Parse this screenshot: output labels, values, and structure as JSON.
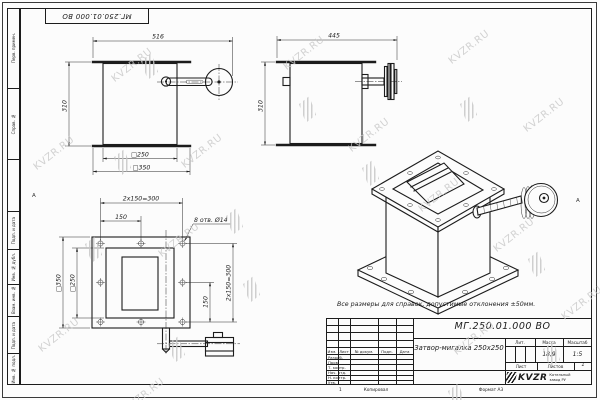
{
  "sheet": {
    "stamp_top_left": "МГ.250.01.000 ВО",
    "zone_letter": "А",
    "bottom_zone_number": "1",
    "copied_label": "Копировал",
    "format_label": "Формат А3",
    "note": "Все размеры для справок, допустимые отклонения ±50мм."
  },
  "margin": {
    "fields": [
      "Перв. примен.",
      "Справ. №",
      "Подп. и дата",
      "Инв. № дубл.",
      "Взам. инв. №",
      "Подп. и дата",
      "Инв. № подл."
    ]
  },
  "watermark": {
    "text": "KVZR.RU",
    "color": "#c7c7c7"
  },
  "views": {
    "front": {
      "width": "516",
      "height": "310",
      "inner_square": "□250",
      "outer_square": "□350"
    },
    "side": {
      "width": "445",
      "height": "310"
    },
    "plan": {
      "bolt_spacing_h": "2x150=300",
      "bolt_half_h": "150",
      "holes_note": "8 отв. Ø14",
      "inner_square": "□250",
      "outer_square": "□350",
      "bolt_spacing_v": "2x150=300",
      "bolt_half_v": "150"
    }
  },
  "title_block": {
    "doc_number": "МГ.250.01.000 ВО",
    "product_name": "Затвор-мигалка 250x250",
    "change_headers": [
      "Изм.",
      "Лист",
      "№ докум.",
      "Подп.",
      "Дата"
    ],
    "signature_rows": [
      "Разраб.",
      "Пров.",
      "Т. контр.",
      "Нач. отд.",
      "Н. контр.",
      "Утв."
    ],
    "lit_label": "Лит.",
    "mass_label": "Масса",
    "scale_label": "Масштаб",
    "mass_value": "18,9",
    "scale_value": "1:5",
    "sheet_label": "Лист",
    "sheets_label": "Листов",
    "sheets_value": "1",
    "company_logo": "KVZR",
    "company_name": "Котельный завод РУ"
  }
}
